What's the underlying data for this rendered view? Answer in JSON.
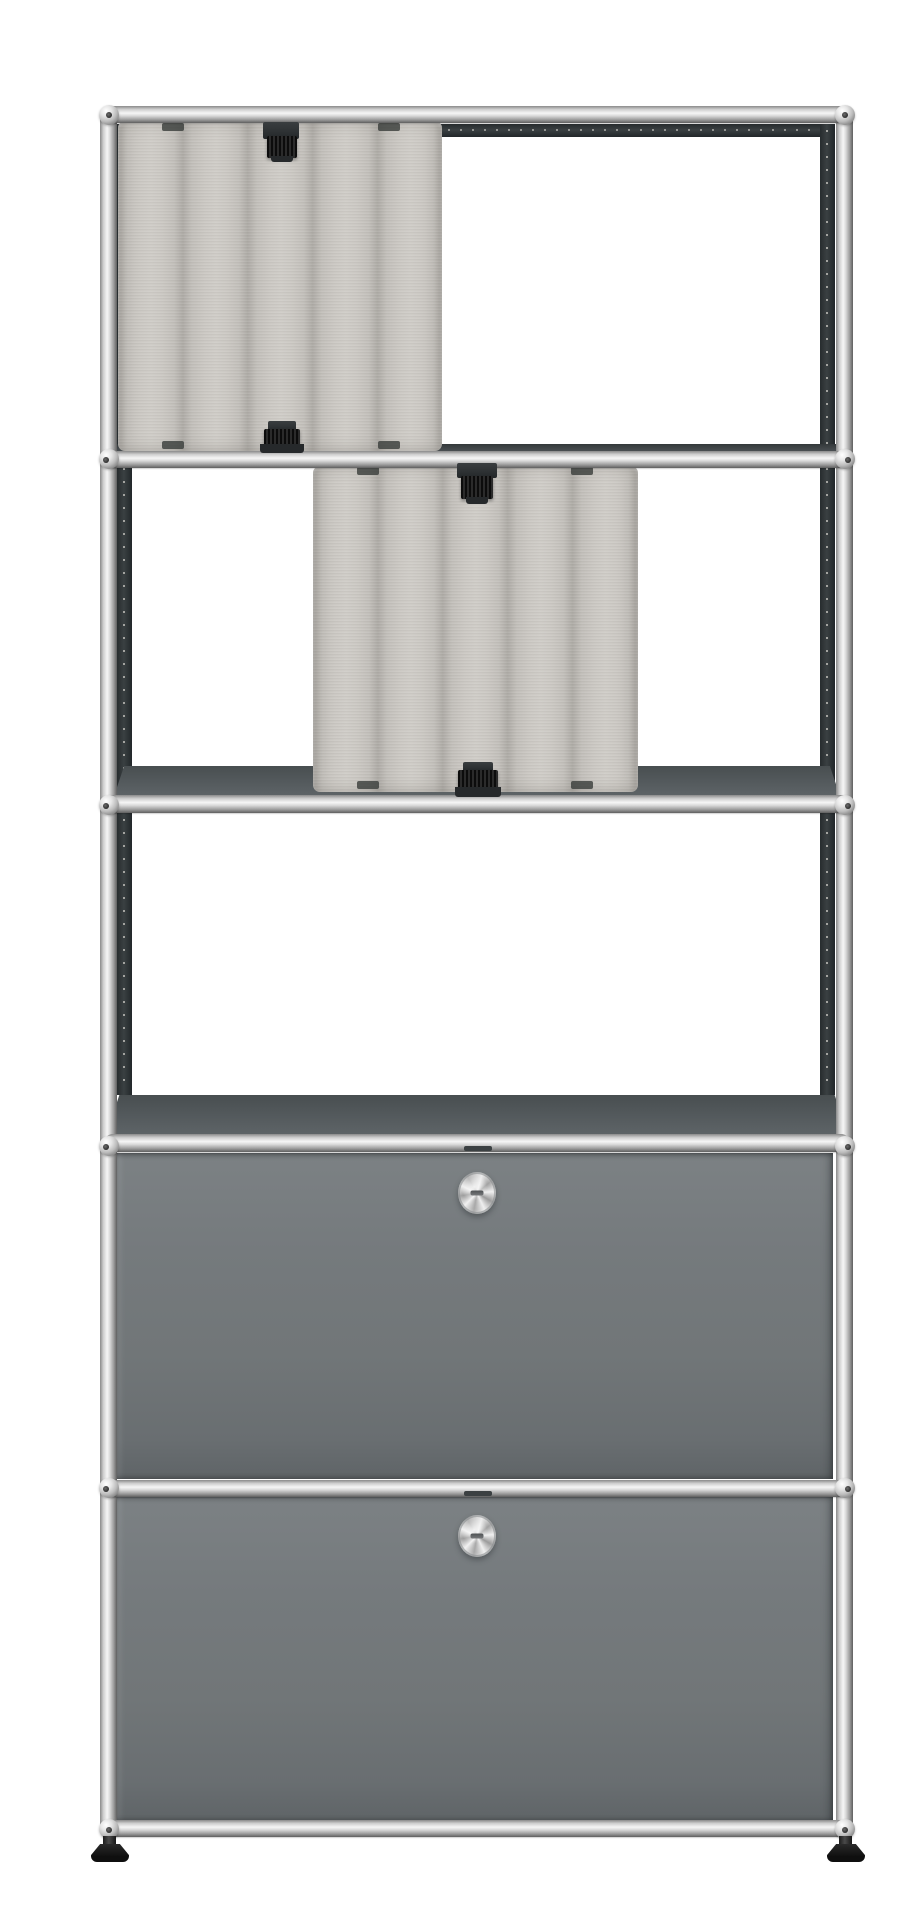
{
  "page": {
    "background": "#ffffff",
    "description": "Frontal product photo of a five-row modular chrome-frame shelving unit on a white background. Two light-gray quilted felt acoustic panels hang with black clips in the upper rows, the middle row is empty, and the two lower rows are closed gray metal drop-down doors, each with a round chrome knob. The unit stands on two black glide feet."
  },
  "unit": {
    "frame": {
      "material": "polished chrome tube with ball connectors",
      "columns": 2,
      "rows": 5,
      "ball_joint_rows": 6,
      "inner_rail_style": "dark perforated mounting rails"
    },
    "rows": [
      {
        "index": 1,
        "content": "felt acoustic panel",
        "position": "left half",
        "clips": 2
      },
      {
        "index": 2,
        "content": "felt acoustic panel",
        "position": "center",
        "clips": 2
      },
      {
        "index": 3,
        "content": "empty open compartment"
      },
      {
        "index": 4,
        "content": "metal drop-down door",
        "knob": "round chrome knob"
      },
      {
        "index": 5,
        "content": "metal drop-down door",
        "knob": "round chrome knob"
      }
    ],
    "knob_count": 2,
    "feet": {
      "count": 2,
      "type": "adjustable black glides"
    }
  },
  "colors": {
    "background": "#ffffff",
    "chrome_highlight": "#f6f6f6",
    "chrome_shadow": "#5f5f5f",
    "door_gray": "#72777a",
    "shelf_top_gray": "#53595c",
    "felt_gray": "#c8c5c0",
    "rail_dark": "#2f3436",
    "clip_black": "#141414",
    "feet_black": "#111111"
  }
}
